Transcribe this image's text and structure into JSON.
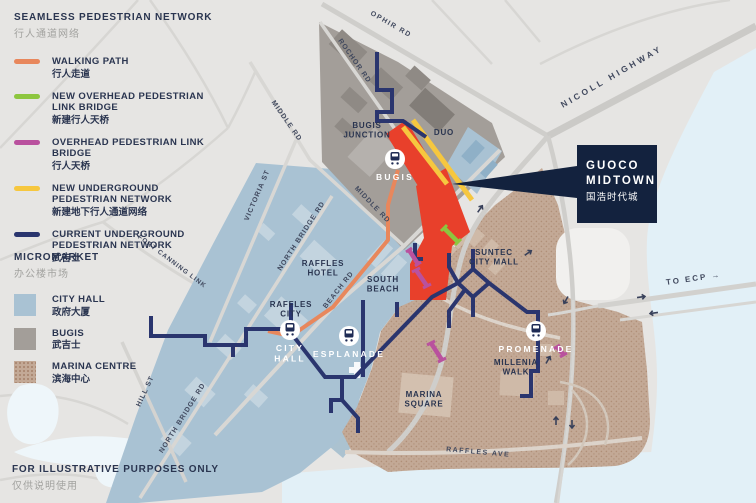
{
  "title": {
    "en": "SEAMLESS PEDESTRIAN NETWORK",
    "zh": "行人通道网络"
  },
  "legend": {
    "items": [
      {
        "id": "walking-path",
        "en": "WALKING PATH",
        "zh": "行人走道",
        "color": "#E8875C"
      },
      {
        "id": "new-overhead-link-bridge",
        "en": "NEW OVERHEAD PEDESTRIAN LINK BRIDGE",
        "zh": "新建行人天桥",
        "color": "#8DC63F"
      },
      {
        "id": "overhead-link-bridge",
        "en": "OVERHEAD PEDESTRIAN LINK BRIDGE",
        "zh": "行人天桥",
        "color": "#B9519E"
      },
      {
        "id": "new-underground-network",
        "en": "NEW UNDERGROUND PEDESTRIAN NETWORK",
        "zh": "新建地下行人通道网络",
        "color": "#F6C73F"
      },
      {
        "id": "current-underground-network",
        "en": "CURRENT UNDERGROUND PEDESTRIAN NETWORK",
        "zh": "武吉士",
        "color": "#2A356E"
      }
    ]
  },
  "micromarket": {
    "title": {
      "en": "MICROMARKET",
      "zh": "办公楼市场"
    },
    "items": [
      {
        "id": "city-hall",
        "en": "CITY HALL",
        "zh": "政府大厦",
        "color": "#A9C2D3"
      },
      {
        "id": "bugis",
        "en": "BUGIS",
        "zh": "武吉士",
        "color": "#A39E99"
      },
      {
        "id": "marina-centre",
        "en": "MARINA CENTRE",
        "zh": "滨海中心",
        "color": "#C3A996"
      }
    ]
  },
  "disclaimer": {
    "en": "FOR ILLUSTRATIVE PURPOSES ONLY",
    "zh": "仅供说明使用"
  },
  "callout": {
    "line1": "GUOCO",
    "line2": "MIDTOWN",
    "zh": "国浩时代城",
    "bg": "#13223E",
    "site_color": "#E8402B"
  },
  "map": {
    "roads": [
      {
        "id": "ophir-rd",
        "label": "OPHIR RD"
      },
      {
        "id": "rochor-rd",
        "label": "ROCHOR RD"
      },
      {
        "id": "nicoll-highway",
        "label": "NICOLL HIGHWAY"
      },
      {
        "id": "middle-rd-upper",
        "label": "MIDDLE RD"
      },
      {
        "id": "middle-rd-lower",
        "label": "MIDDLE RD"
      },
      {
        "id": "victoria-st",
        "label": "VICTORIA ST"
      },
      {
        "id": "north-bridge-rd-upper",
        "label": "NORTH BRIDGE RD"
      },
      {
        "id": "north-bridge-rd-lower",
        "label": "NORTH BRIDGE RD"
      },
      {
        "id": "beach-rd",
        "label": "BEACH RD"
      },
      {
        "id": "fort-canning-link",
        "label": "FORT CANNING LINK"
      },
      {
        "id": "hill-st",
        "label": "HILL ST"
      },
      {
        "id": "raffles-ave",
        "label": "RAFFLES AVE"
      },
      {
        "id": "to-ecp",
        "label": "TO ECP →"
      }
    ],
    "places": [
      {
        "id": "bugis-junction",
        "label": "BUGIS JUNCTION"
      },
      {
        "id": "duo",
        "label": "DUO"
      },
      {
        "id": "raffles-hotel",
        "label": "RAFFLES HOTEL"
      },
      {
        "id": "south-beach",
        "label": "SOUTH BEACH"
      },
      {
        "id": "raffles-city",
        "label": "RAFFLES CITY"
      },
      {
        "id": "suntec-city-mall",
        "label": "SUNTEC CITY MALL"
      },
      {
        "id": "marina-square",
        "label": "MARINA SQUARE"
      },
      {
        "id": "millenia-walk",
        "label": "MILLENIA WALK"
      }
    ],
    "stations": [
      {
        "id": "bugis",
        "label": "BUGIS"
      },
      {
        "id": "city-hall",
        "label": "CITY HALL"
      },
      {
        "id": "esplanade",
        "label": "ESPLANADE"
      },
      {
        "id": "promenade",
        "label": "PROMENADE"
      }
    ]
  }
}
